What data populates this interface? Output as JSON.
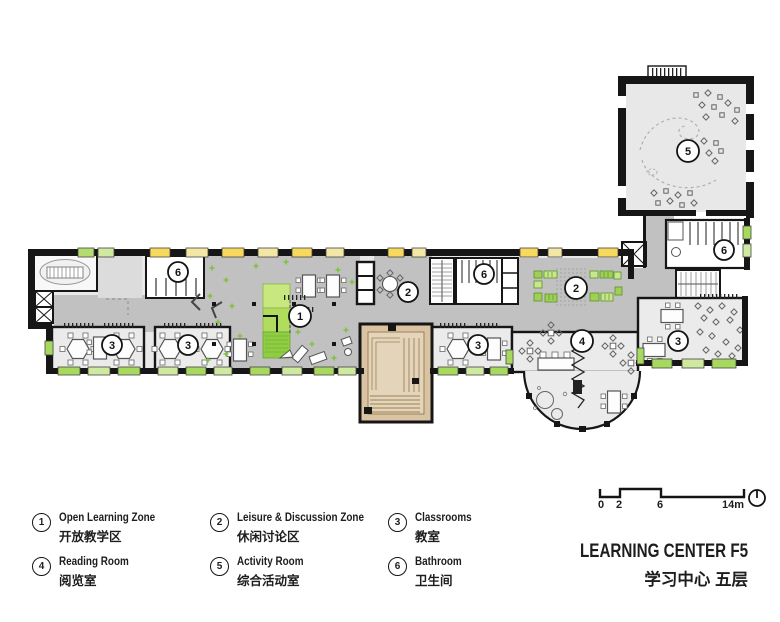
{
  "rooms": {
    "open": {
      "num": "1",
      "name": "Open Learning Zone"
    },
    "leisure": {
      "num": "2",
      "name": "Leisure & Discussion Zone"
    },
    "classroom": {
      "num": "3",
      "name": "Classrooms"
    },
    "reading": {
      "num": "4",
      "name": "Reading Room"
    },
    "activity": {
      "num": "5",
      "name": "Activity Room"
    },
    "bathroom": {
      "num": "6",
      "name": "Bathroom"
    }
  },
  "legend": {
    "items": [
      {
        "num": "1",
        "en": "Open Learning Zone",
        "zh": "开放教学区"
      },
      {
        "num": "2",
        "en": "Leisure & Discussion Zone",
        "zh": "休闲讨论区"
      },
      {
        "num": "3",
        "en": "Classrooms",
        "zh": "教室"
      },
      {
        "num": "4",
        "en": "Reading Room",
        "zh": "阅览室"
      },
      {
        "num": "5",
        "en": "Activity Room",
        "zh": "综合活动室"
      },
      {
        "num": "6",
        "en": "Bathroom",
        "zh": "卫生间"
      }
    ]
  },
  "scalebar": {
    "labels": [
      "0",
      "2",
      "6",
      "14m"
    ]
  },
  "title": {
    "en": "LEARNING CENTER F5",
    "zh": "学习中心 五层"
  },
  "colors": {
    "wall": "#161616",
    "room_light": "#e9e9e9",
    "corridor_gray": "#c1c1c1",
    "window_yellow": "#f8d95e",
    "window_yellow_pale": "#f3e7a6",
    "window_green": "#a8d95f",
    "window_green_pale": "#cfe9a0",
    "furniture_green": "#9ed153",
    "furniture_green_light": "#c8e68a",
    "auditorium_tan": "#d9c3a2"
  }
}
